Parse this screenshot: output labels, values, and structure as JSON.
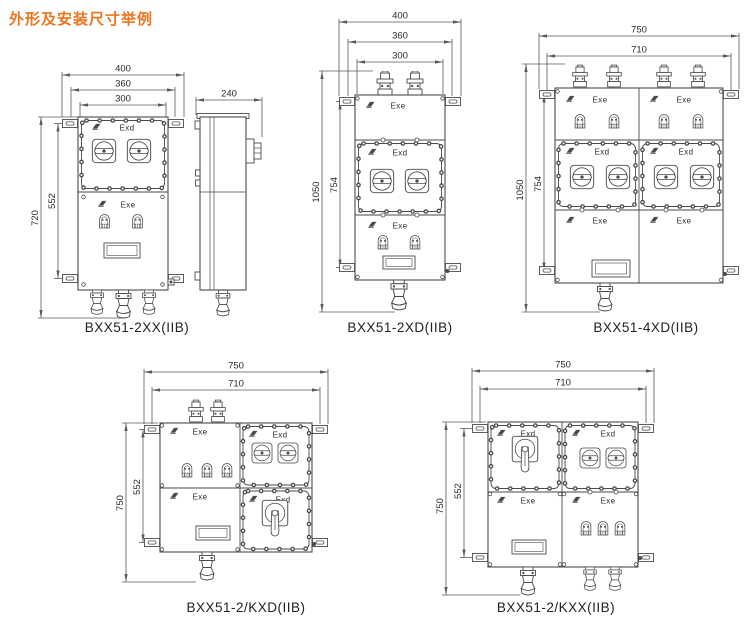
{
  "page": {
    "title": "外形及安装尺寸举例"
  },
  "colors": {
    "title_accent": "#ee7420",
    "drawing_line": "#4a4a4a",
    "dim_line": "#5a5a5a"
  },
  "diagrams": {
    "d1": {
      "caption": "BXX51-2XX(IIB)",
      "dims": {
        "w1": "400",
        "w2": "360",
        "w3": "300",
        "h1": "720",
        "h2": "552",
        "side": "240"
      },
      "sections": {
        "s1": "Exd",
        "s2": "Exe"
      }
    },
    "d2": {
      "caption": "BXX51-2XD(IIB)",
      "dims": {
        "w1": "400",
        "w2": "360",
        "w3": "300",
        "h1": "1050",
        "h2": "754"
      },
      "sections": {
        "s1": "Exe",
        "s2": "Exd",
        "s3": "Exe"
      }
    },
    "d3": {
      "caption": "BXX51-4XD(IIB)",
      "dims": {
        "w1": "750",
        "w2": "710",
        "h1": "1050",
        "h2": "754"
      },
      "sections": {
        "s1": "Exe",
        "s2": "Exe",
        "s3": "Exd",
        "s4": "Exd",
        "s5": "Exe",
        "s6": "Exe"
      }
    },
    "d4": {
      "caption": "BXX51-2/KXD(IIB)",
      "dims": {
        "w1": "750",
        "w2": "710",
        "h1": "750",
        "h2": "552"
      },
      "sections": {
        "s1": "Exe",
        "s2": "Exd",
        "s3": "Exe",
        "s4": "Exd"
      }
    },
    "d5": {
      "caption": "BXX51-2/KXX(IIB)",
      "dims": {
        "w1": "750",
        "w2": "710",
        "h1": "750",
        "h2": "552"
      },
      "sections": {
        "s1": "Exd",
        "s2": "Exd",
        "s3": "Exe",
        "s4": "Exe"
      }
    }
  }
}
